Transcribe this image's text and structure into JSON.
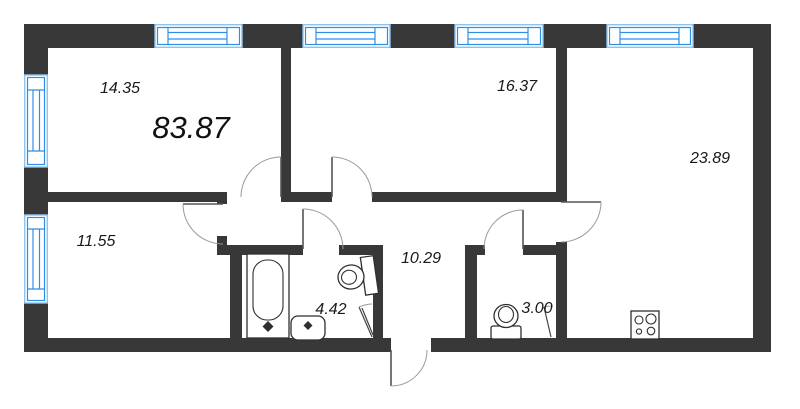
{
  "plan": {
    "total_area": "83.87",
    "rooms": [
      {
        "name": "room-top-left",
        "area": "14.35"
      },
      {
        "name": "room-top-middle",
        "area": "16.37"
      },
      {
        "name": "kitchen-living",
        "area": "23.89"
      },
      {
        "name": "room-bottom-left",
        "area": "11.55"
      },
      {
        "name": "hallway",
        "area": "10.29"
      },
      {
        "name": "bathroom",
        "area": "4.42"
      },
      {
        "name": "wc",
        "area": "3.00"
      }
    ],
    "colors": {
      "wall": "#383838",
      "window_frame_outer": "#8cc3f2",
      "window_frame_inner": "#2e8fe8",
      "door_arc": "#9a9a9a",
      "background": "#ffffff",
      "text": "#1a1a1a"
    }
  }
}
